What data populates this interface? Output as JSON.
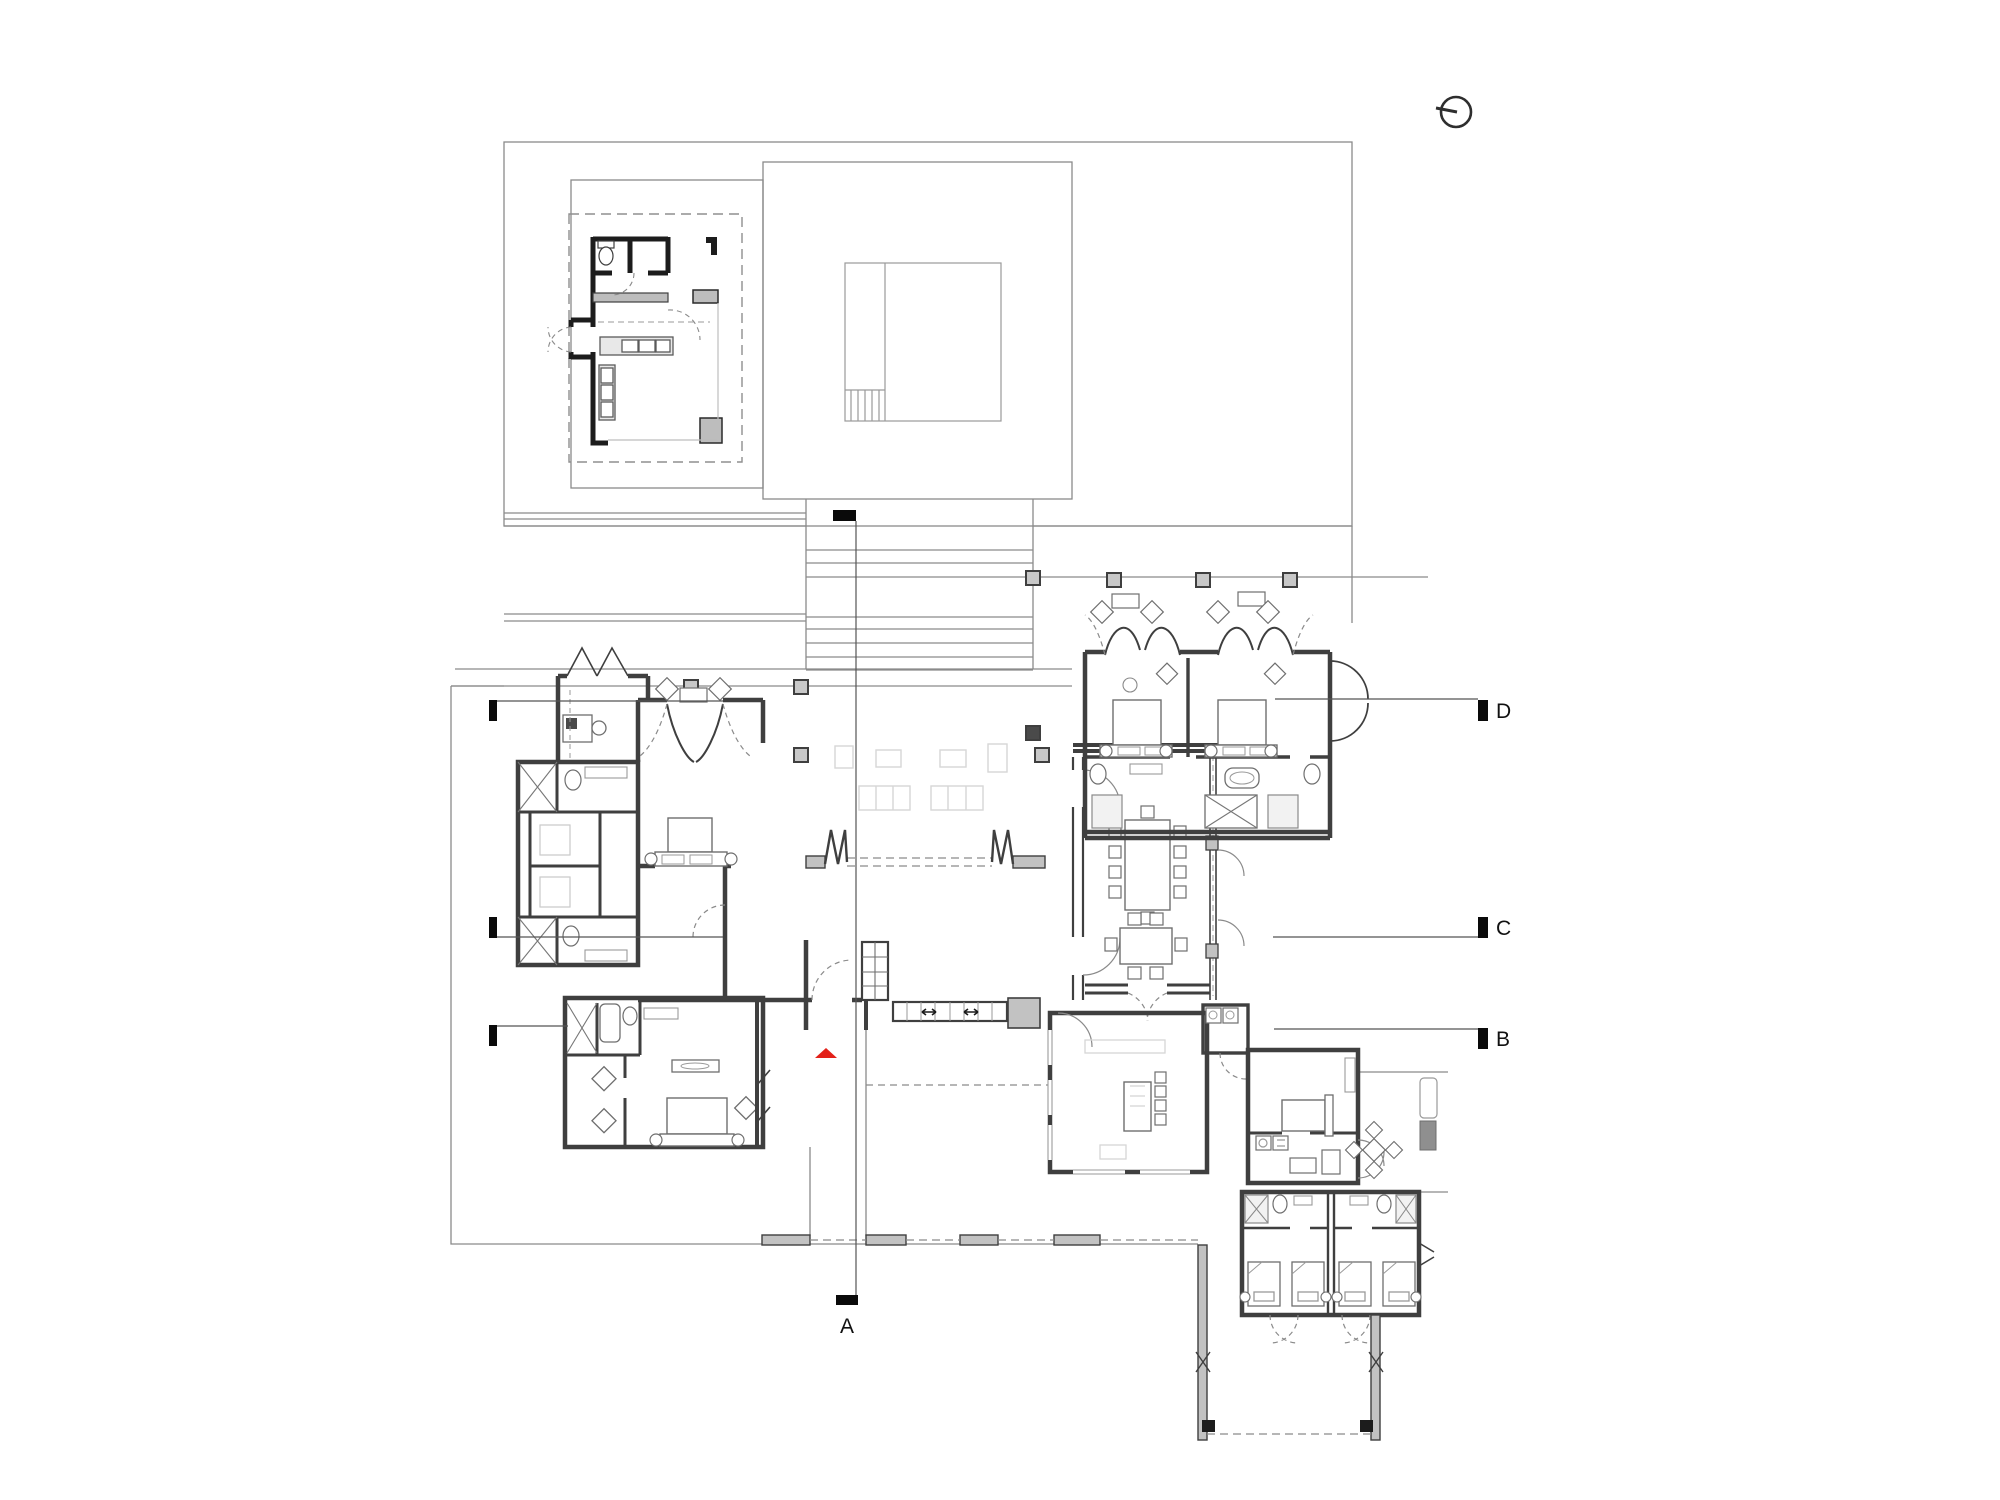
{
  "title": "residence-floor-plan",
  "section_markers": {
    "a": "A",
    "b": "B",
    "c": "C",
    "d": "D"
  },
  "icons": {
    "north_indicator": "north-arrow-icon",
    "entry_marker": "entry-arrow-icon"
  },
  "colors": {
    "background": "#ffffff",
    "site_line": "#8a8a8a",
    "wall_stroke": "#3f3f3f",
    "wall_fill": "#c2c2c2",
    "dark_fill": "#4a4a4a",
    "marker_black": "#0a0a0a",
    "ghost_furniture": "#d9d9d9",
    "furniture_stroke": "#6e6e6e",
    "entry_arrow_red": "#e32119",
    "label_text": "#111111"
  }
}
